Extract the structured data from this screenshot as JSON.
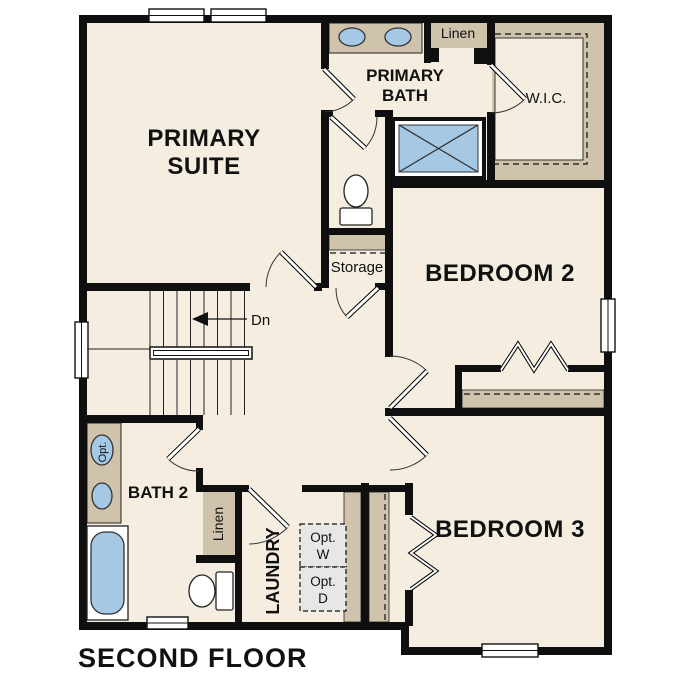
{
  "plan": {
    "title": "SECOND FLOOR",
    "rooms": {
      "primary_suite": {
        "line1": "PRIMARY",
        "line2": "SUITE"
      },
      "primary_bath": {
        "line1": "PRIMARY",
        "line2": "BATH"
      },
      "walk_in_closet": "W.I.C.",
      "bedroom_2": "BEDROOM 2",
      "bedroom_3": "BEDROOM 3",
      "bath_2": "BATH 2",
      "laundry": "LAUNDRY",
      "storage": "Storage",
      "linen_upper": "Linen",
      "linen_lower": "Linen"
    },
    "annotations": {
      "stair_direction": "Dn",
      "opt_washer_line1": "Opt.",
      "opt_washer_line2": "W",
      "opt_dryer_line1": "Opt.",
      "opt_dryer_line2": "D",
      "opt_sink": "Opt."
    },
    "colors": {
      "wall": "#0f0f0f",
      "floor": "#f5eee0",
      "casework_tan": "#cfc3ab",
      "fixture_blue": "#a5c8e4",
      "appliance_gray": "#e5e8e4",
      "background": "#ffffff"
    }
  }
}
